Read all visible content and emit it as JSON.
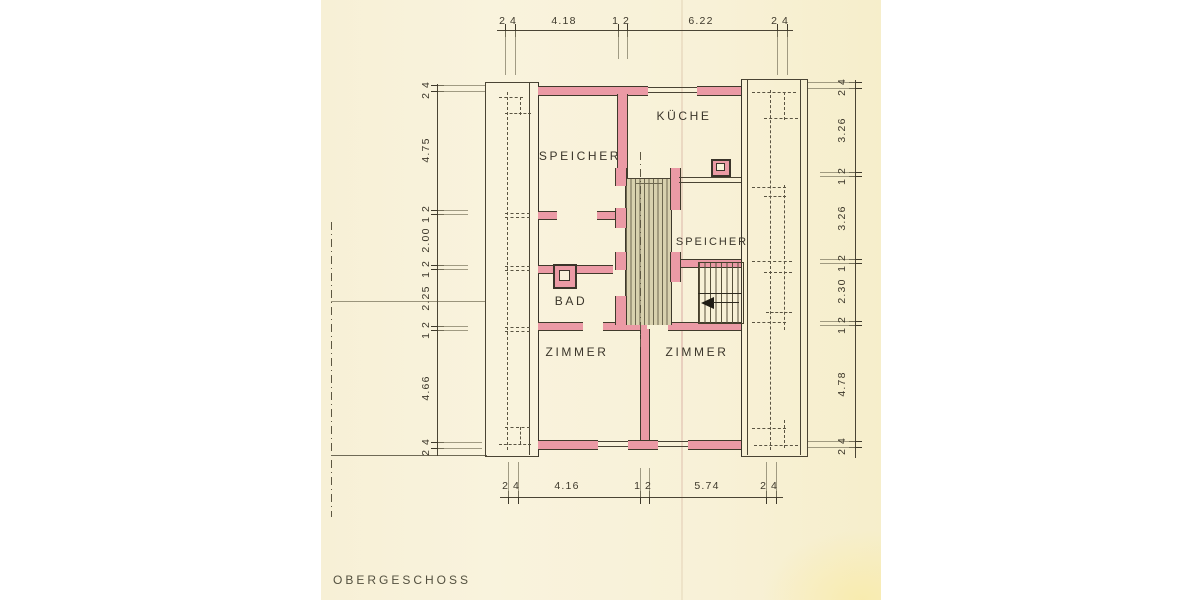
{
  "title": "OBERGESCHOSS",
  "rooms": {
    "speicher_left": "SPEICHER",
    "kueche": "KÜCHE",
    "speicher_right": "SPEICHER",
    "bad": "BAD",
    "zimmer_left": "ZIMMER",
    "zimmer_right": "ZIMMER"
  },
  "dims": {
    "top": [
      "24",
      "4.18",
      "12",
      "6.22",
      "24"
    ],
    "bottom": [
      "24",
      "4.16",
      "12",
      "5.74",
      "24"
    ],
    "left": [
      "24",
      "4.75",
      "12",
      "2.00",
      "12",
      "2.25",
      "12",
      "4.66",
      "24"
    ],
    "right": [
      "24",
      "3.26",
      "12",
      "3.26",
      "12",
      "2.30",
      "12",
      "4.78",
      "24"
    ]
  },
  "colors": {
    "paper": "#f8f1d7",
    "wall_fill": "#eb9aa5",
    "ink": "#3e392b",
    "hatch": "#6e6850"
  }
}
